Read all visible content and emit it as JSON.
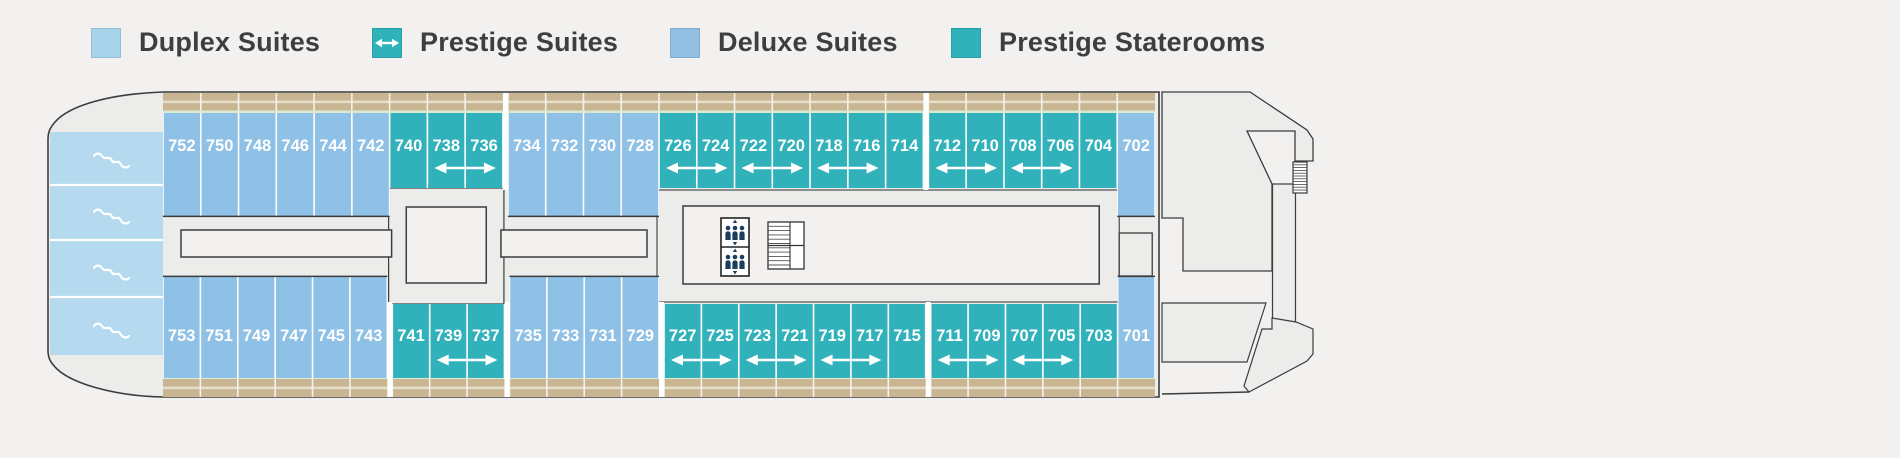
{
  "legend": {
    "items": [
      {
        "label": "Duplex Suites",
        "type": "duplex",
        "arrow": false
      },
      {
        "label": "Prestige Suites",
        "type": "prestige",
        "arrow": true
      },
      {
        "label": "Deluxe Suites",
        "type": "deluxe",
        "arrow": false
      },
      {
        "label": "Prestige Staterooms",
        "type": "stateroom",
        "arrow": false
      }
    ]
  },
  "colors": {
    "background": "#F2F1F0",
    "hull": "#ECECEA",
    "inner_area": "#F2F1F0",
    "outline": "#3C3C3C",
    "duplex": "#B5DAEF",
    "deluxe": "#8FC0E6",
    "prestige": "#31B2BA",
    "legend_duplex": "#A7D4EA",
    "legend_deluxe": "#92BFE2",
    "legend_prestige": "#2FB2BA",
    "balcony_tan": "#C9B592",
    "balcony_tan_light": "#E6DEC8",
    "deck_green_line": "#D9E9D2",
    "cabin_number_text": "#FFFFFF",
    "legend_text": "#3E3E3E",
    "icon_navy": "#1C3D5E"
  },
  "deck_plan": {
    "top_row": {
      "cabins": [
        {
          "number": "752",
          "type": "deluxe"
        },
        {
          "number": "750",
          "type": "deluxe"
        },
        {
          "number": "748",
          "type": "deluxe"
        },
        {
          "number": "746",
          "type": "deluxe"
        },
        {
          "number": "744",
          "type": "deluxe"
        },
        {
          "number": "742",
          "type": "deluxe"
        },
        {
          "number": "740",
          "type": "prestige"
        },
        {
          "number": "738",
          "type": "prestige"
        },
        {
          "number": "736",
          "type": "prestige"
        },
        {
          "number": "734",
          "type": "deluxe"
        },
        {
          "number": "732",
          "type": "deluxe"
        },
        {
          "number": "730",
          "type": "deluxe"
        },
        {
          "number": "728",
          "type": "deluxe"
        },
        {
          "number": "726",
          "type": "prestige"
        },
        {
          "number": "724",
          "type": "prestige"
        },
        {
          "number": "722",
          "type": "prestige"
        },
        {
          "number": "720",
          "type": "prestige"
        },
        {
          "number": "718",
          "type": "prestige"
        },
        {
          "number": "716",
          "type": "prestige"
        },
        {
          "number": "714",
          "type": "prestige"
        },
        {
          "number": "712",
          "type": "prestige"
        },
        {
          "number": "710",
          "type": "prestige"
        },
        {
          "number": "708",
          "type": "prestige"
        },
        {
          "number": "706",
          "type": "prestige"
        },
        {
          "number": "704",
          "type": "prestige"
        },
        {
          "number": "702",
          "type": "deluxe"
        }
      ],
      "gaps_after": [
        "736",
        "714"
      ],
      "connected_pairs": [
        [
          "738",
          "736"
        ],
        [
          "726",
          "724"
        ],
        [
          "722",
          "720"
        ],
        [
          "718",
          "716"
        ],
        [
          "712",
          "710"
        ],
        [
          "708",
          "706"
        ]
      ]
    },
    "bottom_row": {
      "cabins": [
        {
          "number": "753",
          "type": "deluxe"
        },
        {
          "number": "751",
          "type": "deluxe"
        },
        {
          "number": "749",
          "type": "deluxe"
        },
        {
          "number": "747",
          "type": "deluxe"
        },
        {
          "number": "745",
          "type": "deluxe"
        },
        {
          "number": "743",
          "type": "deluxe"
        },
        {
          "number": "741",
          "type": "prestige"
        },
        {
          "number": "739",
          "type": "prestige"
        },
        {
          "number": "737",
          "type": "prestige"
        },
        {
          "number": "735",
          "type": "deluxe"
        },
        {
          "number": "733",
          "type": "deluxe"
        },
        {
          "number": "731",
          "type": "deluxe"
        },
        {
          "number": "729",
          "type": "deluxe"
        },
        {
          "number": "727",
          "type": "prestige"
        },
        {
          "number": "725",
          "type": "prestige"
        },
        {
          "number": "723",
          "type": "prestige"
        },
        {
          "number": "721",
          "type": "prestige"
        },
        {
          "number": "719",
          "type": "prestige"
        },
        {
          "number": "717",
          "type": "prestige"
        },
        {
          "number": "715",
          "type": "prestige"
        },
        {
          "number": "711",
          "type": "prestige"
        },
        {
          "number": "709",
          "type": "prestige"
        },
        {
          "number": "707",
          "type": "prestige"
        },
        {
          "number": "705",
          "type": "prestige"
        },
        {
          "number": "703",
          "type": "prestige"
        },
        {
          "number": "701",
          "type": "deluxe"
        }
      ],
      "gaps_after": [
        "743",
        "737",
        "729",
        "715"
      ],
      "connected_pairs": [
        [
          "739",
          "737"
        ],
        [
          "727",
          "725"
        ],
        [
          "723",
          "721"
        ],
        [
          "719",
          "717"
        ],
        [
          "711",
          "709"
        ],
        [
          "707",
          "705"
        ]
      ]
    },
    "bow_duplex_sections": 4,
    "icons": {
      "elevator": "elevator-icon",
      "stairs": "stairs-icon",
      "stern_stairs": "stern-stairs-icon",
      "duplex_stairs": "duplex-stairs-icon"
    }
  }
}
